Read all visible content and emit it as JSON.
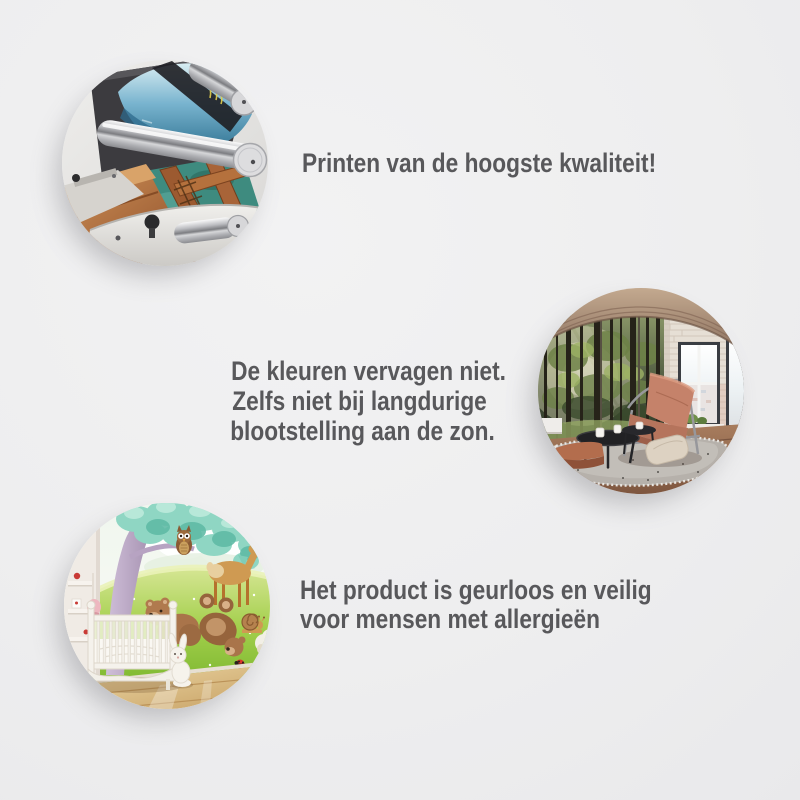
{
  "page": {
    "background_color": "#eeeeef",
    "text_color": "#58585b"
  },
  "features": [
    {
      "image_name": "printing-machine-photo",
      "image_description": "Large-format printer with chrome rollers printing a wall mural of a wooden pier over teal water",
      "lines": [
        "Printen van de hoogste kwaliteit!"
      ]
    },
    {
      "image_name": "living-room-forest-mural-photo",
      "image_description": "Loft living room with sunlit forest photo wallpaper, salmon leather armchair, round black tables and large windows",
      "lines": [
        "De kleuren vervagen niet.",
        "Zelfs niet bij langdurige",
        "blootstelling aan de zon."
      ]
    },
    {
      "image_name": "nursery-cartoon-mural-photo",
      "image_description": "Nursery with cartoon wall mural of deer, bears and owl in a meadow behind a white crib with plush bunny",
      "lines": [
        "Het product is geurloos en veilig",
        "voor mensen met allergieën"
      ]
    }
  ]
}
